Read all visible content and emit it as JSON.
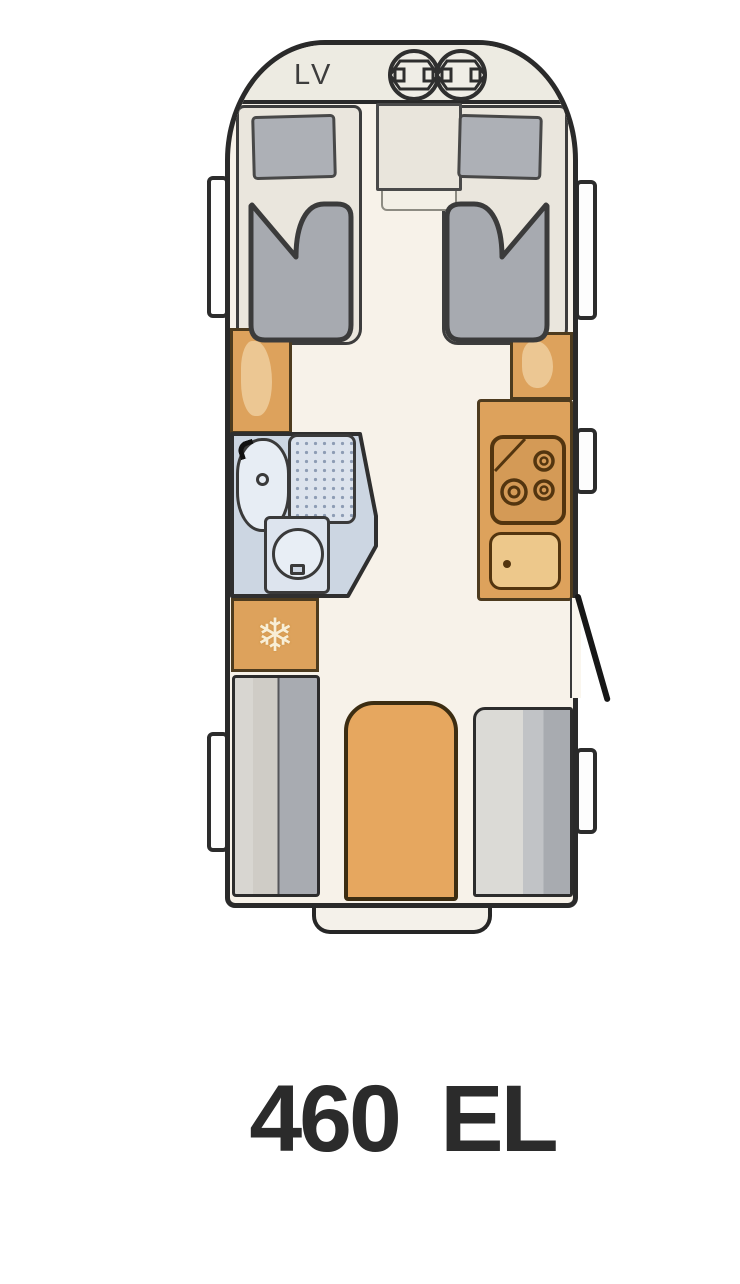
{
  "floorplan": {
    "model": "460 EL",
    "front_label": "LV"
  },
  "icons": {
    "snowflake": "❄",
    "gas_bottle": "gas-bottle-icon",
    "hob_burners": "stove-burner-icon",
    "sink_drain": "drain-icon"
  },
  "colors": {
    "outline": "#2a2a2a",
    "floor": "#f7f2e9",
    "bed_base": "#eae6dd",
    "mattress": "#a7aab0",
    "pillow": "#adb0b6",
    "furniture_orange": "#dda25c",
    "sink_orange": "#edc88b",
    "bathroom_blue": "#ccd6e2",
    "fixture_blue": "#e7edf4",
    "bench_light": "#d8d6d1",
    "bench_dark": "#a8abb1",
    "window_fill": "#fdfdfd",
    "text": "#2b2b2b"
  }
}
